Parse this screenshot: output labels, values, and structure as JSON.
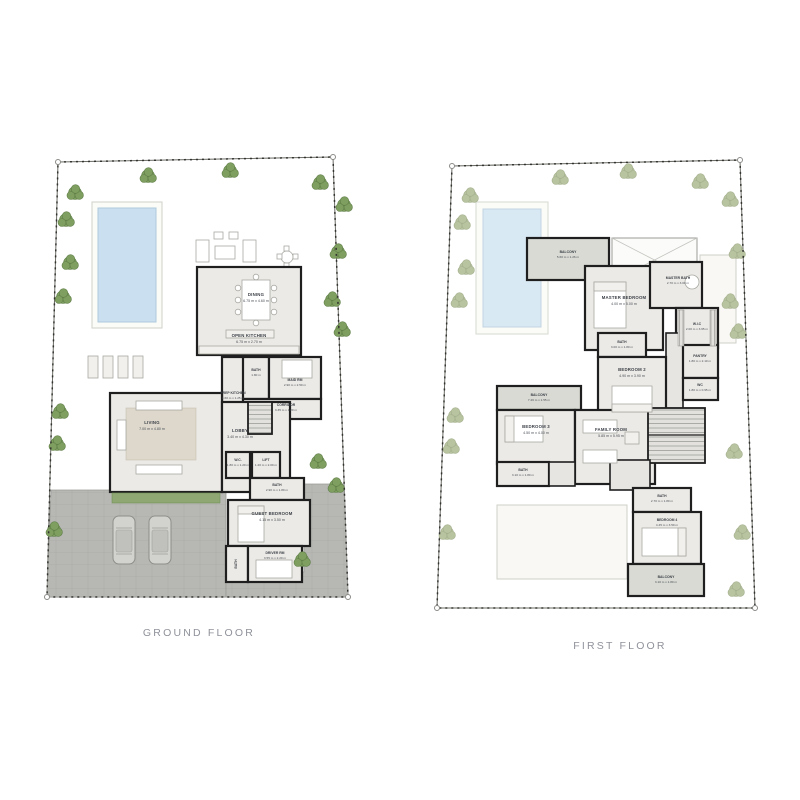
{
  "colors": {
    "background": "#ffffff",
    "garden_ground": "#a6ba8b",
    "garden_first": "#dde2d0",
    "pool_water_ground": "#cadff0",
    "pool_water_first": "#d9e9f4",
    "pool_deck": "#fbfbf8",
    "wall": "#1f1f1f",
    "floor": "#eceae6",
    "balcony_floor": "#d8dad3",
    "pavement": "#b7b8b4",
    "tree_ground": "#7f9f60",
    "tree_first": "#b8c3a0",
    "label_text": "#3c4148",
    "caption_text": "#8f929a"
  },
  "ground_floor": {
    "caption": "GROUND FLOOR",
    "rooms": {
      "dining": {
        "name": "DINING",
        "dims": "6.75 m x 4.60 m"
      },
      "open_kitchen": {
        "name": "OPEN KITCHEN",
        "dims": "6.75 m x 2.70 m"
      },
      "bath_maid": {
        "name": "BATH",
        "dims": "1.80 m"
      },
      "maid_rm": {
        "name": "MAID RM",
        "dims": "2.90 m x 2.50 m"
      },
      "prep_kitchen": {
        "name": "PREP KITCHEN",
        "dims": "4.60 m x 1.25 m"
      },
      "corridor": {
        "name": "CORRIDOR",
        "dims": "3.35 m x 1.20 m"
      },
      "living": {
        "name": "LIVING",
        "dims": "7.00 m x 4.80 m"
      },
      "lobby": {
        "name": "LOBBY",
        "dims": "3.40 m x 4.30 m"
      },
      "wc": {
        "name": "W.C.",
        "dims": "1.80 m x 1.20 m"
      },
      "lift": {
        "name": "LIFT",
        "dims": "1.20 m x 2.00 m"
      },
      "bath_guest": {
        "name": "BATH",
        "dims": "2.90 m x 1.80 m"
      },
      "guest_bedroom": {
        "name": "GUEST BEDROOM",
        "dims": "4.15 m x 3.50 m"
      },
      "driver_rm": {
        "name": "DRIVER RM",
        "dims": "3.55 m x 2.20 m"
      },
      "bath_driver": {
        "name": "BATH",
        "dims": ""
      }
    }
  },
  "first_floor": {
    "caption": "FIRST FLOOR",
    "rooms": {
      "balcony_top": {
        "name": "BALCONY",
        "dims": "5.60 m x 1.26 m"
      },
      "master_bedroom": {
        "name": "MASTER BEDROOM",
        "dims": "4.00 m x 5.00 m"
      },
      "master_bath": {
        "name": "MASTER BATH",
        "dims": "2.70 m x 3.00 m"
      },
      "wic": {
        "name": "W.I.C",
        "dims": "2.00 m x 3.65 m"
      },
      "bath_2": {
        "name": "BATH",
        "dims": "3.00 m x 1.80 m"
      },
      "bedroom_2": {
        "name": "BEDROOM 2",
        "dims": "4.90 m x 3.90 m"
      },
      "pantry": {
        "name": "PANTRY",
        "dims": "1.80 m x 2.10 m"
      },
      "wc": {
        "name": "WC",
        "dims": "1.80 m x 0.95 m"
      },
      "balcony_left": {
        "name": "BALCONY",
        "dims": "7.26 m x 1.55 m"
      },
      "bedroom_3": {
        "name": "BEDROOM 3",
        "dims": "4.50 m x 4.00 m"
      },
      "family_room": {
        "name": "FAMILY ROOM",
        "dims": "5.85 m x 5.95 m"
      },
      "bath_3": {
        "name": "BATH",
        "dims": "3.10 m x 1.80 m"
      },
      "bath_4": {
        "name": "BATH",
        "dims": "2.70 m x 1.80 m"
      },
      "bedroom_4": {
        "name": "BEDROOM 4",
        "dims": "4.45 m x 3.50 m"
      },
      "balcony_bottom": {
        "name": "BALCONY",
        "dims": "3.10 m x 1.80 m"
      }
    }
  }
}
